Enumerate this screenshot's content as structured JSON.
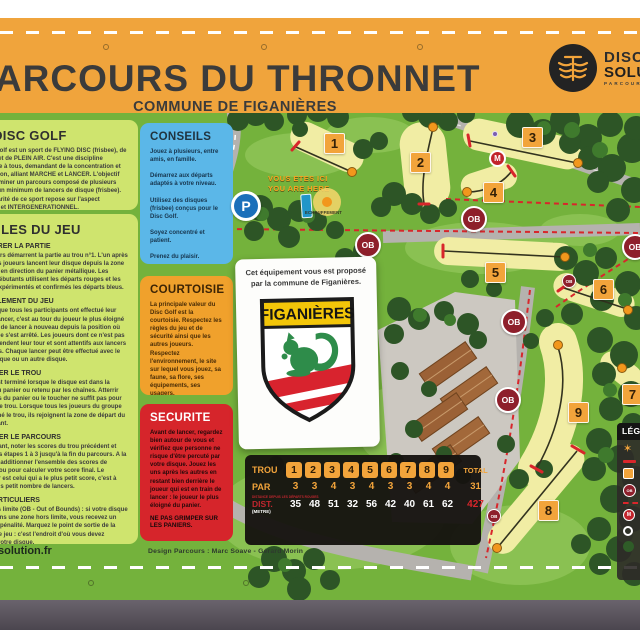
{
  "header": {
    "title": "PARCOURS DU THRONNET",
    "subtitle": "COMMUNE DE FIGANIÈRES",
    "logo": {
      "line1": "DISC",
      "line2": "SOLUTION",
      "tagline": "PARCOURS"
    }
  },
  "panels": {
    "golf": {
      "title": "LE DISC GOLF",
      "body": "Le Disc Golf est un sport de FLYING DISC (frisbee), de NATURE et de PLEIN AIR. C'est une discipline accessible à tous, demandant de la concentration et de précision, alliant MARCHE et LANCER. L'objectif est de terminer un parcours composé de plusieurs trous en un minimum de lancers de disque (frisbee). La Popularité de ce sport repose sur l'aspect LUDIQUE et INTERGENERATIONNEL."
    },
    "rules": {
      "title": "RÈGLES DU JEU",
      "sections": [
        {
          "title": "DÉMARRER LA PARTIE",
          "body": "Les joueurs démarrent la partie au trou n°1. L'un après l'autre, les joueurs lancent leur disque depuis la zone de départ en direction du panier métallique. Les joueurs débutants utilisent les départs rouges et les joueurs expérimentés et confirmés les départs bleus."
        },
        {
          "title": "DÉROULEMENT DU JEU",
          "body": "Une fois que tous les participants ont effectué leur premier lancer, c'est au tour du joueur le plus éloigné du panier de lancer à nouveau depuis la position où son disque s'est arrêté. Les joueurs dont ce n'est pas le tour attendent leur tour et sont attentifs aux lancers des autres. Chaque lancer peut être effectué avec le même disque ou un autre disque."
        },
        {
          "title": "TERMINER LE TROU",
          "body": "Le trou est terminé lorsque le disque est dans la nacelle du panier ou retenu par les chaînes. Atterrir au-dessus du panier ou le toucher ne suffit pas pour terminer le trou. Lorsque tous les joueurs du groupe ont terminé le trou, ils rejoignent la zone de départ du trou suivant."
        },
        {
          "title": "TERMINER LE PARCOURS",
          "body": "En avançant, noter les scores du trou précédent et répéter les étapes 1 à 3 jusqu'à la fin du parcours. A la fin, il faut additionner l'ensemble des scores de chaque trou pour calculer votre score final. Le vainqueur est celui qui a le plus petit score, c'est à dire le plus petit nombre de lancers."
        },
        {
          "title": "CAS PARTICULIERS",
          "body": "Zone hors limite (OB - Out of Bounds) : si votre disque atterrit dans une zone hors limite, vous recevez un lancer de pénalité. Marquez le point de sortie de la surface de jeu : c'est l'endroit d'où vous devez relancer votre disque.\n\nDisque en hauteur : rejouer de la position au sol se trouvant à la verticale du disque coincé en hauteur.\n\nLorsque vous êtes à 10 mètres ou moins du panier, vous êtes dans la zone de « putt ». Lorsque vous avez relâché votre disque, vous devez garder l'équilibre et ne pas passer devant de votre position."
        }
      ]
    },
    "conseils": {
      "title": "CONSEILS",
      "body": "Jouez à plusieurs, entre amis, en famille.\n\nDémarrez aux départs adaptés à votre niveau.\n\nUtilisez des disques (frisbee) conçus pour le Disc Golf.\n\nSoyez concentré et patient.\n\nPrenez du plaisir."
    },
    "courtoisie": {
      "title": "COURTOISIE",
      "body": "La principale valeur du Disc Golf est la courtoisie. Respectez les règles du jeu et de sécurité ainsi que les autres joueurs. Respectez l'environnement, le site sur lequel vous jouez, sa faune, sa flore, ses équipements, ses usagers."
    },
    "securite": {
      "title": "SECURITE",
      "body": "Avant de lancer, regardez bien autour de vous et vérifiez que personne ne risque d'être percuté par votre disque. Jouez les uns après les autres en restant bien derrière le joueur qui est en train de lancer : le joueur le plus éloigné du panier.",
      "warning": "NE PAS GRIMPER SUR LES PANIERS."
    }
  },
  "map": {
    "you_are_here": "VOUS ETES ICI\nYOU ARE HERE",
    "warmup_label": "ECHAUFFEMENT",
    "parking": "P",
    "ob": "OB",
    "mandatory": "M",
    "holes": [
      "1",
      "2",
      "3",
      "4",
      "5",
      "6",
      "7",
      "8",
      "9"
    ]
  },
  "card": {
    "text": "Cet équipement vous est proposé\npar la commune de Figanières.",
    "shield_title": "FIGANIÈRES"
  },
  "scorecard": {
    "row_hole": "TROU",
    "row_par": "PAR",
    "row_dist": "DIST.",
    "dist_unit": "(METRE)",
    "total_label": "TOTAL",
    "note": "DISTANCE DEPUIS LES DÉPARTS ROUGES",
    "holes": [
      "1",
      "2",
      "3",
      "4",
      "5",
      "6",
      "7",
      "8",
      "9"
    ],
    "par": [
      "3",
      "3",
      "4",
      "3",
      "4",
      "3",
      "3",
      "4",
      "4"
    ],
    "par_total": "31",
    "dist": [
      "35",
      "48",
      "51",
      "32",
      "56",
      "42",
      "40",
      "61",
      "62"
    ],
    "dist_total": "427"
  },
  "legend": {
    "title": "LÉGENDE"
  },
  "footer": {
    "site": "discsolution.fr",
    "credits": "Design Parcours : Marc Soave - Gérard Morin"
  },
  "colors": {
    "frame_orange": "#f0a43c",
    "map_green": "#74b23c",
    "panel_green": "#cfe46e",
    "panel_blue": "#5bb7e8",
    "panel_orange": "#f0a12c",
    "panel_red": "#d6252b",
    "fairway": "#f1eda4",
    "ob_red": "#8e1f2b",
    "hole_sign": "#f2a43b"
  }
}
